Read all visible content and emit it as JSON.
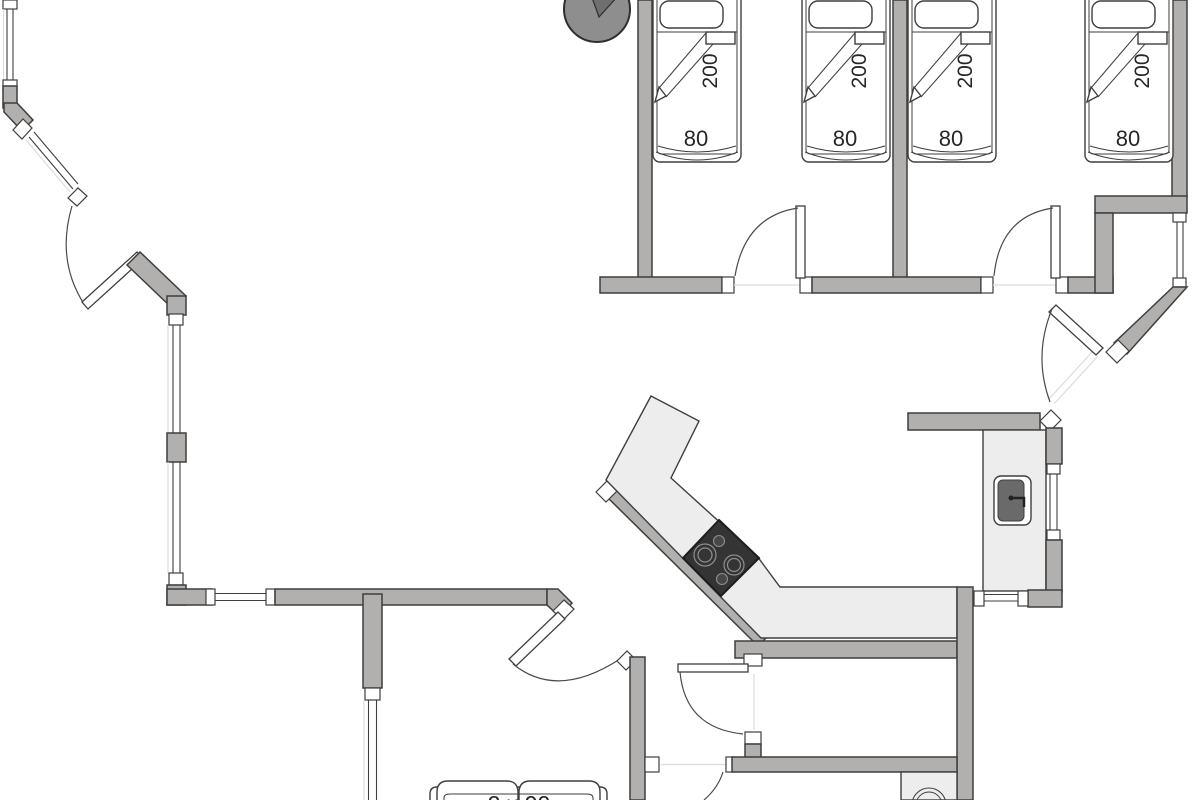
{
  "document": {
    "type": "architectural floor plan",
    "title": "holiday-home floor plan"
  },
  "beds": [
    {
      "name": "single-bed-1",
      "length_label": "200",
      "width_label": "80"
    },
    {
      "name": "single-bed-2",
      "length_label": "200",
      "width_label": "80"
    },
    {
      "name": "single-bed-3",
      "length_label": "200",
      "width_label": "80"
    },
    {
      "name": "single-bed-4",
      "length_label": "200",
      "width_label": "80"
    }
  ],
  "double_bed": {
    "label": "2 x 90"
  },
  "fixtures": {
    "wood_stove": "wood-stove-icon",
    "cooktop": "cooktop-icon",
    "sink": "sink-icon",
    "washing_machine": "washing-machine-icon",
    "kitchen_counter": "kitchen-counter",
    "sink_counter": "sink-counter"
  },
  "colors": {
    "bg_color": "#ffffff",
    "wall_color": "#b1b0ae",
    "outline_color": "#3e3e3e",
    "counter_color": "#ededed",
    "stove_color": "#343434",
    "woodstove_color": "#8e8e8e",
    "guide_color": "#dcdcdc"
  }
}
